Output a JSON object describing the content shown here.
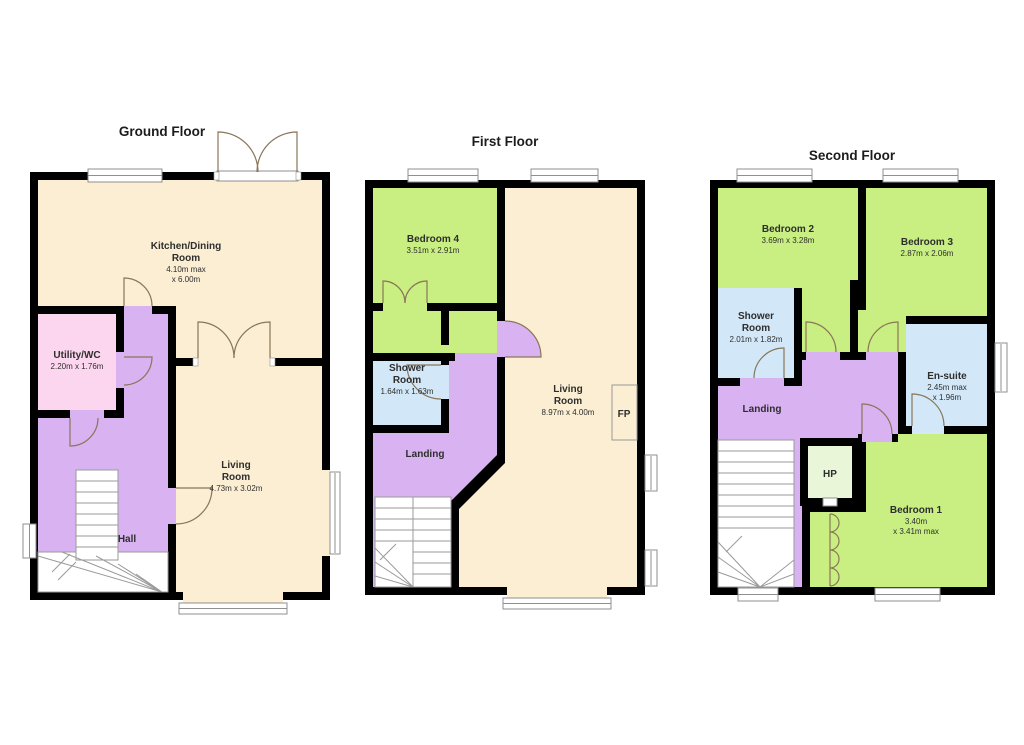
{
  "palette": {
    "wall": "#000000",
    "cream": "#fbeed3",
    "green": "#c9ef83",
    "purple": "#d9b2f2",
    "pink": "#fcd6ee",
    "blue": "#d2e8f8",
    "pale_green": "#eaf6d8",
    "door_stroke": "#8a7558",
    "stair_stroke": "#9a9a9a",
    "window_stroke": "#8f8f8f",
    "text": "#2e2e2e"
  },
  "floors": {
    "ground": {
      "title": "Ground Floor",
      "rooms": {
        "kitchen": {
          "name1": "Kitchen/Dining",
          "name2": "Room",
          "dim1": "4.10m max",
          "dim2": "x 6.00m"
        },
        "utility": {
          "name1": "Utility/WC",
          "dim1": "2.20m x 1.76m"
        },
        "hall": {
          "name1": "Hall"
        },
        "living": {
          "name1": "Living",
          "name2": "Room",
          "dim1": "4.73m x 3.02m"
        }
      }
    },
    "first": {
      "title": "First Floor",
      "rooms": {
        "bedroom4": {
          "name1": "Bedroom 4",
          "dim1": "3.51m x 2.91m"
        },
        "shower": {
          "name1": "Shower",
          "name2": "Room",
          "dim1": "1.64m x 1.63m"
        },
        "landing": {
          "name1": "Landing"
        },
        "living": {
          "name1": "Living",
          "name2": "Room",
          "dim1": "8.97m x 4.00m"
        },
        "fireplace": {
          "label": "FP"
        }
      }
    },
    "second": {
      "title": "Second Floor",
      "rooms": {
        "bedroom2": {
          "name1": "Bedroom 2",
          "dim1": "3.69m x 3.28m"
        },
        "bedroom3": {
          "name1": "Bedroom 3",
          "dim1": "2.87m x 2.06m"
        },
        "shower": {
          "name1": "Shower",
          "name2": "Room",
          "dim1": "2.01m x 1.82m"
        },
        "ensuite": {
          "name1": "En-suite",
          "dim1": "2.45m max",
          "dim2": "x 1.96m"
        },
        "landing": {
          "name1": "Landing"
        },
        "hp": {
          "label": "HP"
        },
        "bedroom1": {
          "name1": "Bedroom 1",
          "dim1": "3.40m",
          "dim2": "x 3.41m max"
        }
      }
    }
  }
}
